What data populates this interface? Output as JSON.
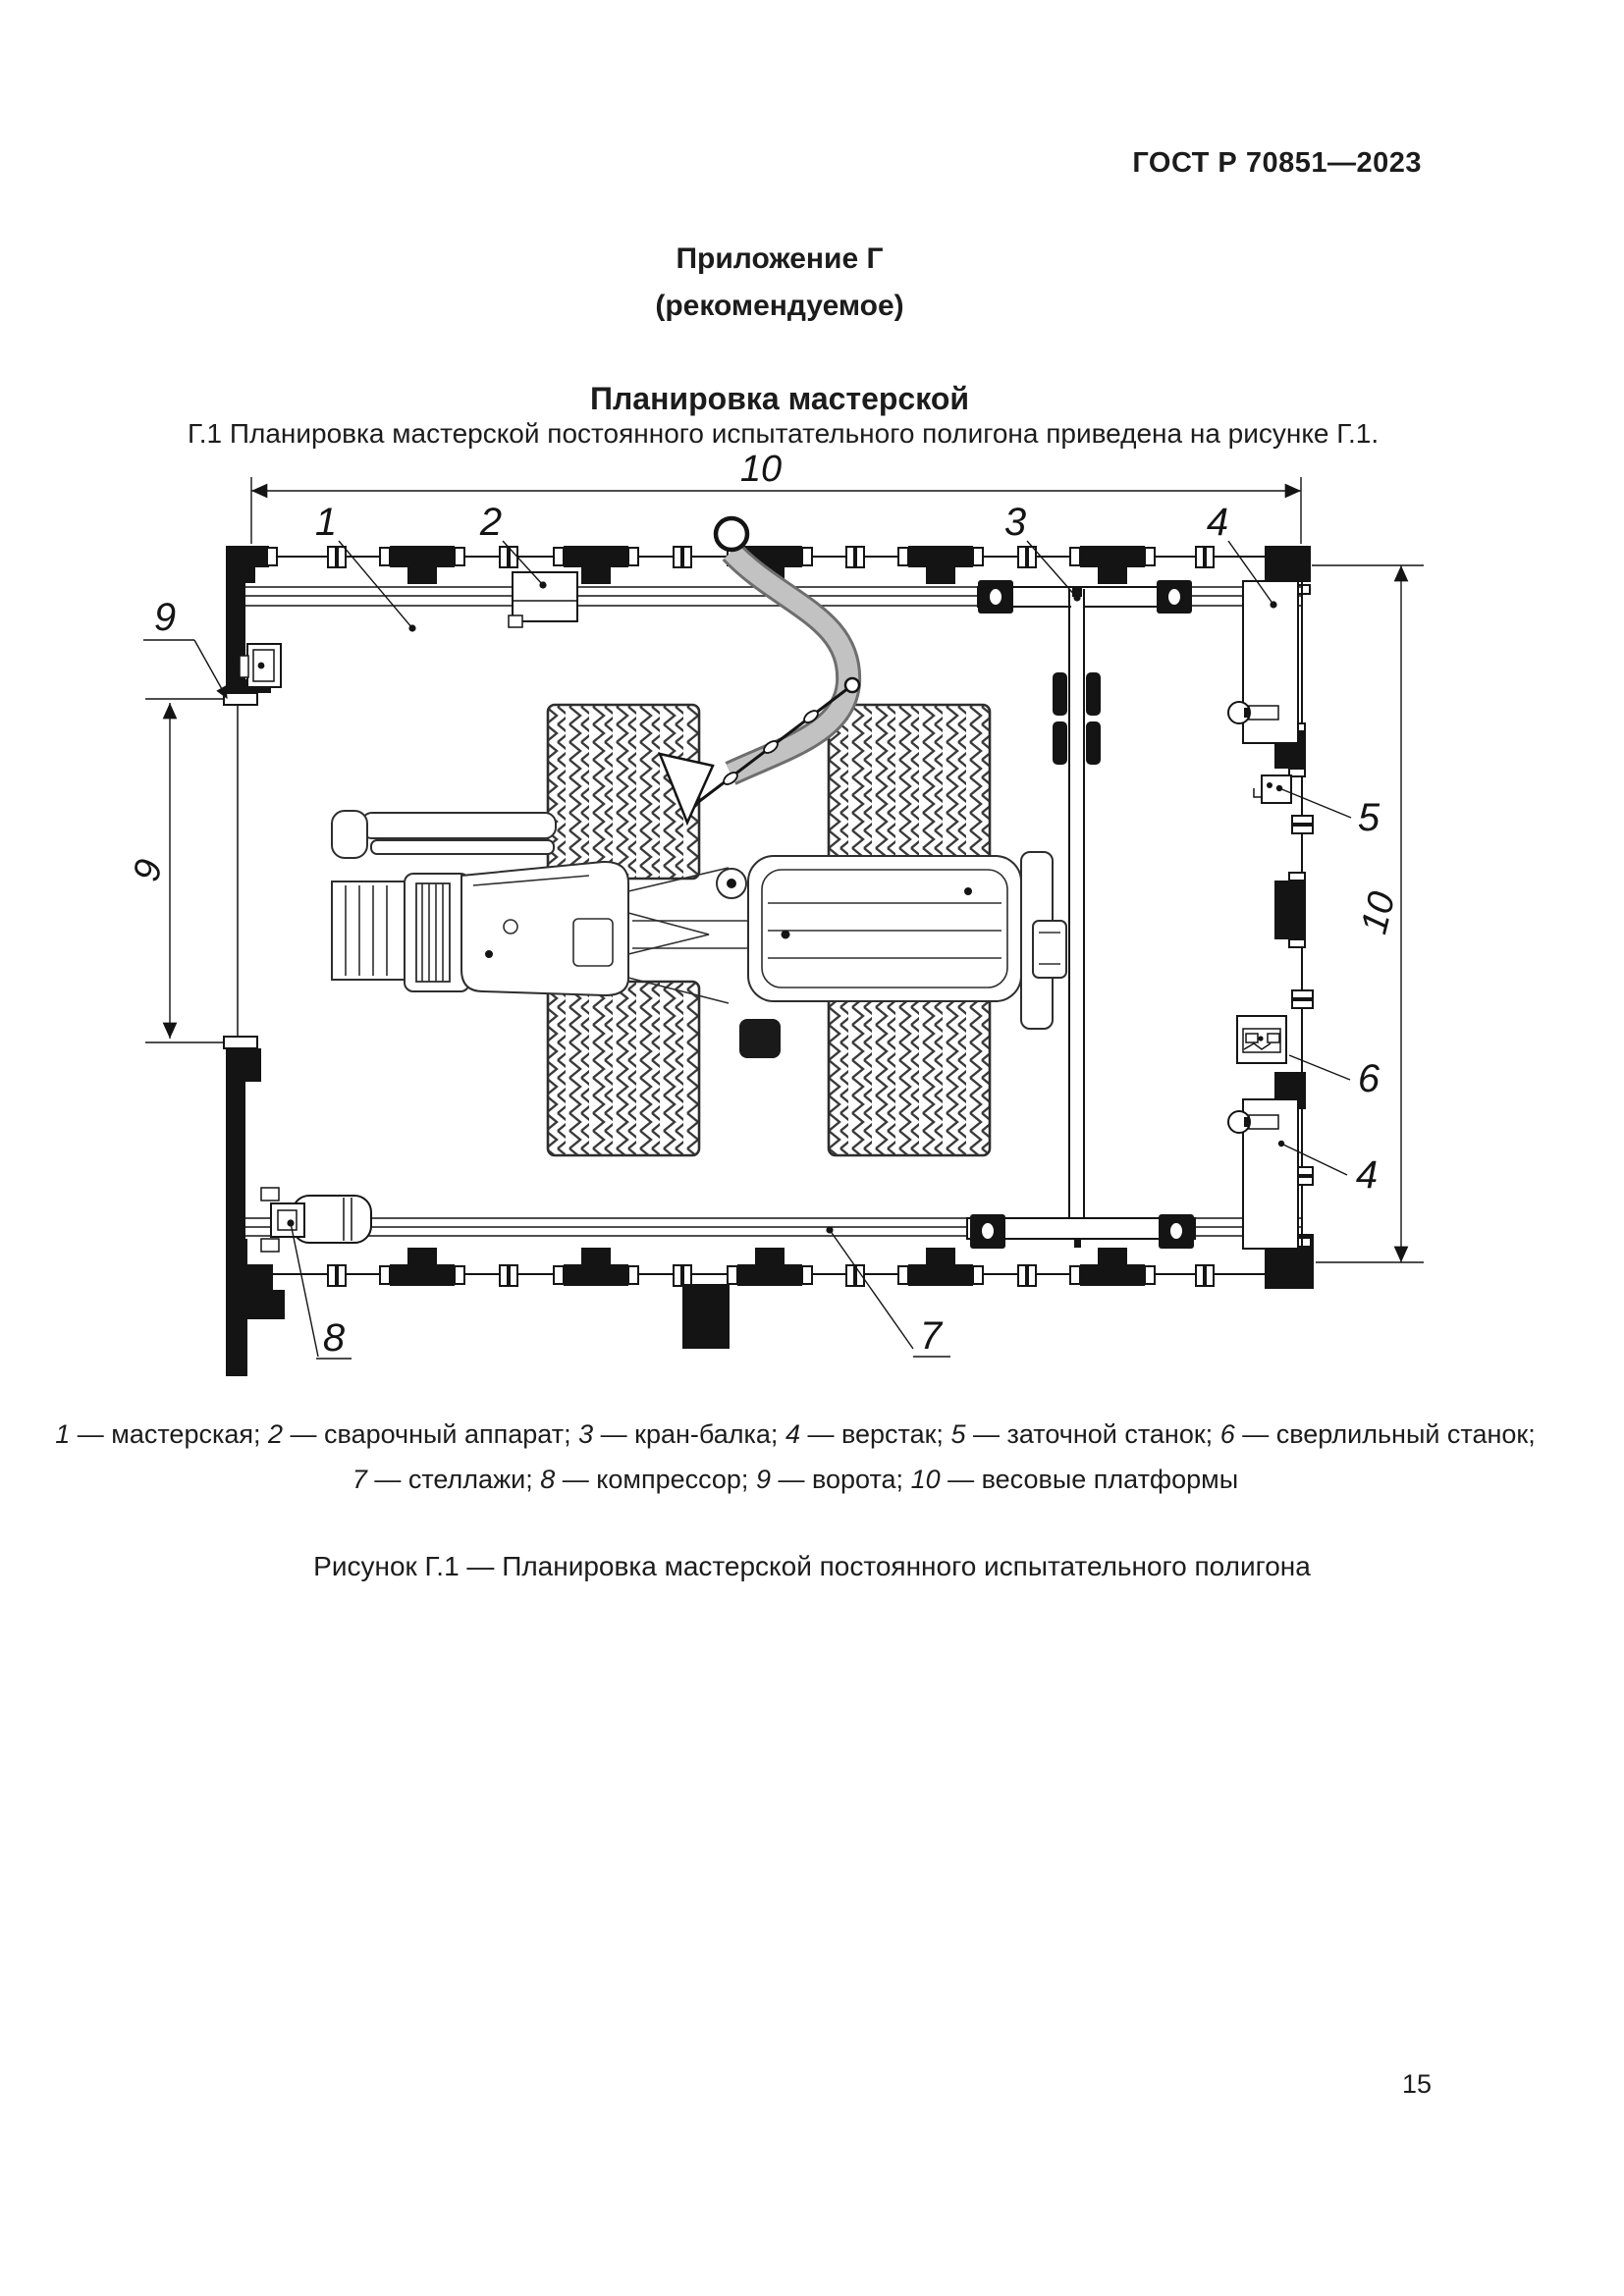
{
  "page": {
    "header": "ГОСТ Р 70851—2023",
    "page_number": "15"
  },
  "appendix": {
    "title_line1": "Приложение Г",
    "title_line2": "(рекомендуемое)",
    "section_title": "Планировка мастерской",
    "paragraph": "Г.1  Планировка мастерской постоянного испытательного полигона приведена на рисунке Г.1."
  },
  "figure": {
    "caption": "Рисунок Г.1 — Планировка мастерской постоянного испытательного полигона",
    "legend_line1": [
      {
        "n": "1",
        "t": "мастерская"
      },
      {
        "n": "2",
        "t": "сварочный аппарат"
      },
      {
        "n": "3",
        "t": "кран-балка"
      },
      {
        "n": "4",
        "t": "верстак"
      },
      {
        "n": "5",
        "t": "заточной станок"
      },
      {
        "n": "6",
        "t": "сверлильный станок"
      }
    ],
    "legend_line2": [
      {
        "n": "7",
        "t": "стеллажи"
      },
      {
        "n": "8",
        "t": "компрессор"
      },
      {
        "n": "9",
        "t": "ворота"
      },
      {
        "n": "10",
        "t": "весовые платформы"
      }
    ],
    "callouts": {
      "workshop": "1",
      "welder": "2",
      "crane": "3",
      "workbench_top": "4",
      "sharpener": "5",
      "drill": "6",
      "workbench_bottom": "4",
      "shelving": "7",
      "compressor": "8",
      "gate": "9"
    },
    "dimensions": {
      "top": "10",
      "right": "10",
      "gate": "9"
    },
    "colors": {
      "ink": "#141414",
      "sling_gray": "#bdbdbd"
    }
  }
}
